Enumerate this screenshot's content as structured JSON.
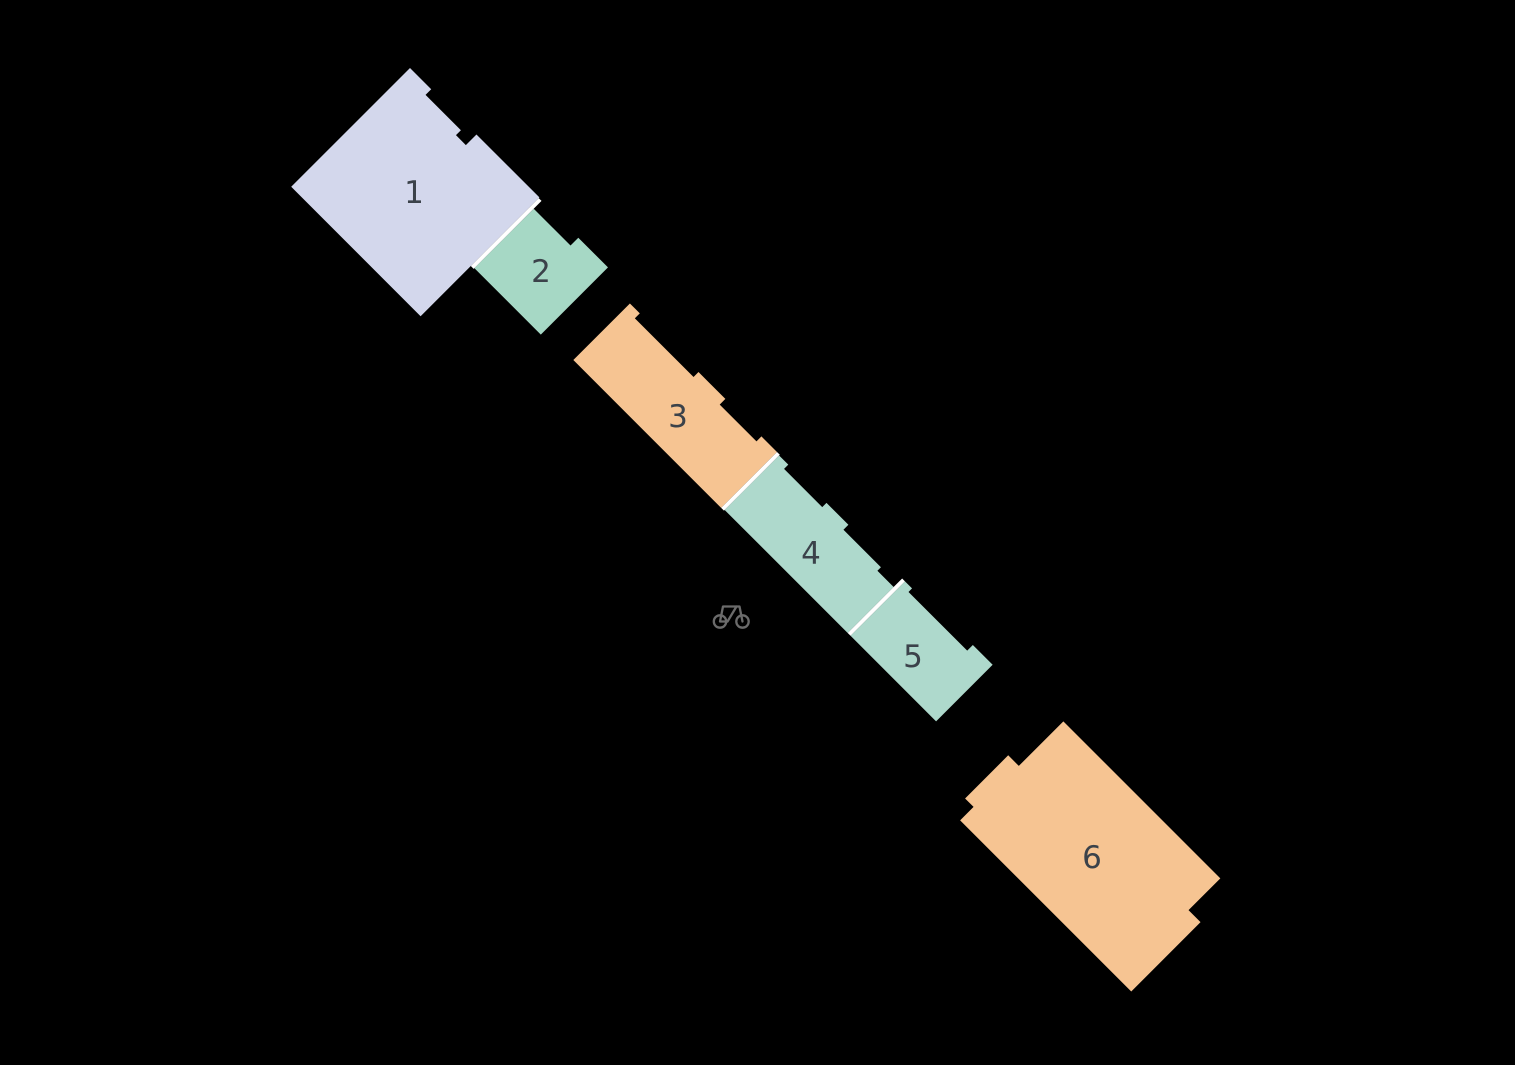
{
  "canvas": {
    "width": 1515,
    "height": 1065,
    "background_color": "#000000"
  },
  "site_plan": {
    "origin": {
      "x": 410,
      "y": 68
    },
    "rotation_deg": 45,
    "label_color": "#3b424a",
    "label_font_size": 31,
    "divider_color": "#ffffff",
    "buildings": [
      {
        "label": "1",
        "fill": "#d3d7ec",
        "label_pos": {
          "x": 414,
          "y": 192
        },
        "points": [
          [
            0,
            0
          ],
          [
            30,
            0
          ],
          [
            30,
            8
          ],
          [
            80,
            8
          ],
          [
            80,
            15
          ],
          [
            94,
            15
          ],
          [
            94,
            0
          ],
          [
            183,
            0
          ],
          [
            183,
            168
          ],
          [
            0,
            168
          ]
        ]
      },
      {
        "label": "2",
        "fill": "#a6d8c5",
        "label_pos": {
          "x": 541,
          "y": 271
        },
        "points": [
          [
            187,
            12
          ],
          [
            239,
            12
          ],
          [
            239,
            1
          ],
          [
            281,
            1
          ],
          [
            281,
            96
          ],
          [
            187,
            96
          ]
        ]
      },
      {
        "label": "3",
        "fill": "#f6c492",
        "label_pos": {
          "x": 678,
          "y": 416
        },
        "points": [
          [
            322,
            11
          ],
          [
            336,
            11
          ],
          [
            336,
            18
          ],
          [
            419,
            18
          ],
          [
            419,
            11
          ],
          [
            457,
            11
          ],
          [
            457,
            19
          ],
          [
            509,
            19
          ],
          [
            509,
            12
          ],
          [
            531,
            12
          ],
          [
            531,
            91
          ],
          [
            322,
            91
          ]
        ]
      },
      {
        "label": "4",
        "fill": "#aed9cc",
        "label_pos": {
          "x": 811,
          "y": 553
        },
        "points": [
          [
            535,
            13
          ],
          [
            548,
            13
          ],
          [
            548,
            19
          ],
          [
            602,
            19
          ],
          [
            602,
            13
          ],
          [
            633,
            13
          ],
          [
            633,
            20
          ],
          [
            686,
            20
          ],
          [
            686,
            25
          ],
          [
            709,
            25
          ],
          [
            709,
            90
          ],
          [
            535,
            90
          ]
        ]
      },
      {
        "label": "5",
        "fill": "#aed9cc",
        "label_pos": {
          "x": 913,
          "y": 656
        },
        "points": [
          [
            713,
            13
          ],
          [
            723,
            13
          ],
          [
            723,
            18
          ],
          [
            806,
            18
          ],
          [
            806,
            10
          ],
          [
            834,
            10
          ],
          [
            834,
            90
          ],
          [
            713,
            90
          ]
        ]
      },
      {
        "label": "6",
        "fill": "#f6c492",
        "label_pos": {
          "x": 1092,
          "y": 857
        },
        "points": [
          [
            924,
            0
          ],
          [
            1146,
            0
          ],
          [
            1146,
            45
          ],
          [
            1163,
            45
          ],
          [
            1163,
            143
          ],
          [
            921,
            143
          ],
          [
            921,
            124
          ],
          [
            909,
            124
          ],
          [
            909,
            63
          ],
          [
            924,
            63
          ]
        ]
      }
    ],
    "dividers": [
      {
        "u": 185,
        "v1": 1,
        "v2": 97,
        "width": 4
      },
      {
        "u": 533,
        "v1": 12,
        "v2": 91,
        "width": 4
      },
      {
        "u": 711,
        "v1": 13,
        "v2": 90,
        "width": 4
      }
    ]
  },
  "icons": {
    "bicycle": {
      "name": "bicycle-icon",
      "color": "#6b6b6b",
      "center": {
        "x": 731,
        "y": 617
      }
    }
  }
}
